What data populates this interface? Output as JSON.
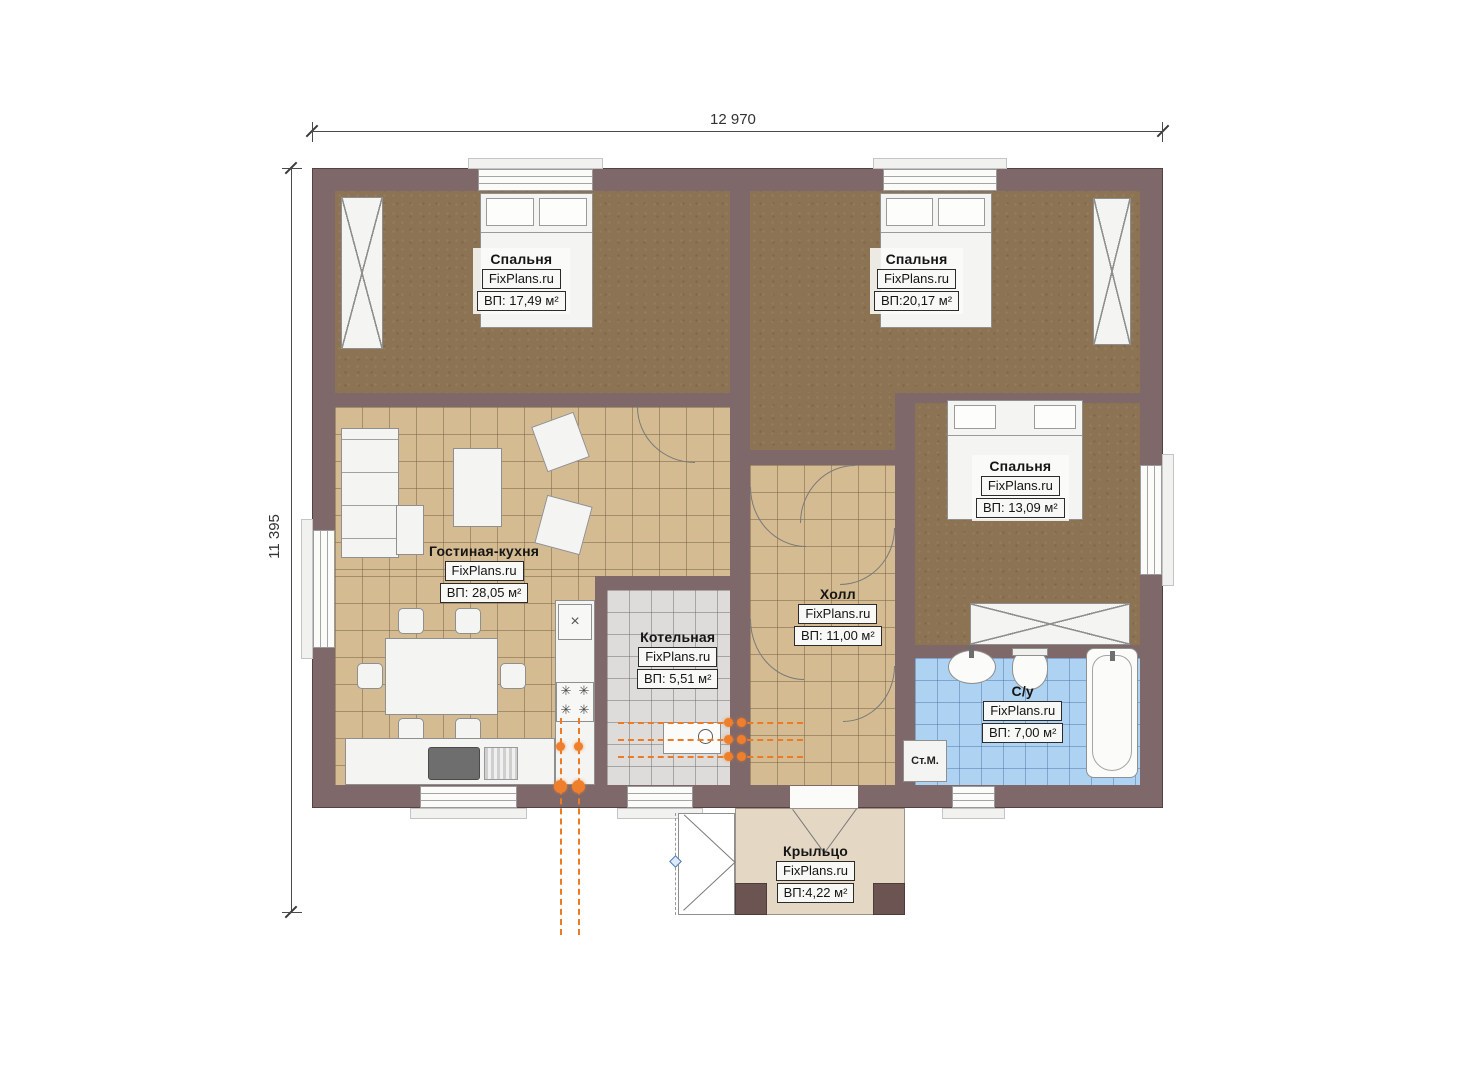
{
  "dimensions": {
    "width": "12 970",
    "height": "11 395"
  },
  "rooms": [
    {
      "id": "bedroom-1",
      "name": "Спальня",
      "brand": "FixPlans.ru",
      "area": "ВП: 17,49 м²"
    },
    {
      "id": "bedroom-2",
      "name": "Спальня",
      "brand": "FixPlans.ru",
      "area": "ВП:20,17 м²"
    },
    {
      "id": "bedroom-3",
      "name": "Спальня",
      "brand": "FixPlans.ru",
      "area": "ВП: 13,09 м²"
    },
    {
      "id": "living-kitchen",
      "name": "Гостиная-кухня",
      "brand": "FixPlans.ru",
      "area": "ВП: 28,05 м²"
    },
    {
      "id": "hall",
      "name": "Холл",
      "brand": "FixPlans.ru",
      "area": "ВП: 11,00 м²"
    },
    {
      "id": "boiler-room",
      "name": "Котельная",
      "brand": "FixPlans.ru",
      "area": "ВП: 5,51 м²"
    },
    {
      "id": "bathroom",
      "name": "С/у",
      "brand": "FixPlans.ru",
      "area": "ВП: 7,00 м²"
    },
    {
      "id": "porch",
      "name": "Крыльцо",
      "brand": "FixPlans.ru",
      "area": "ВП:4,22 м²"
    }
  ],
  "labels": {
    "washing_machine": "Ст.М."
  },
  "icons": {
    "burner": "✳",
    "vent": "×"
  },
  "colors": {
    "wall": "#7f686a",
    "bedroom_floor": "#8c7353",
    "tile_floor": "#d4bb91",
    "boiler_floor": "#dedcda",
    "bathroom_floor": "#aed2f2",
    "porch_floor": "#e4d8c5",
    "gas_line": "#ed7b24"
  }
}
